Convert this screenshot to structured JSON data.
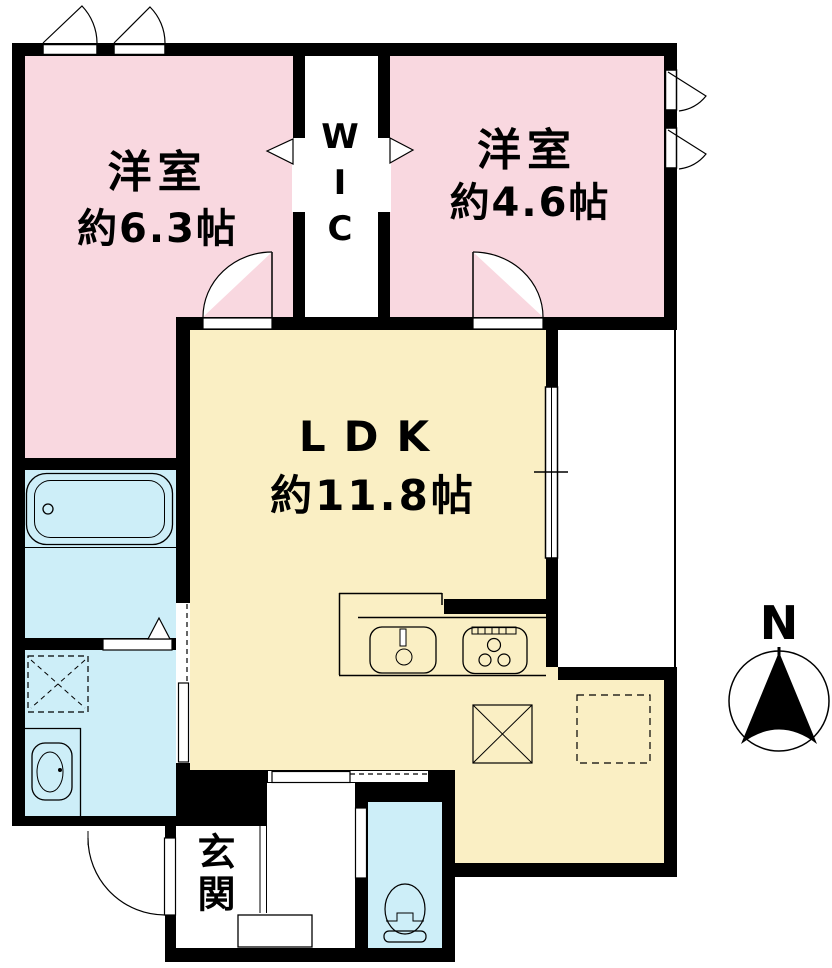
{
  "rooms": {
    "bedroom_west": {
      "name": "洋室",
      "size": "約6.3帖"
    },
    "bedroom_east": {
      "name": "洋室",
      "size": "約4.6帖"
    },
    "ldk": {
      "name": "LDK",
      "size": "約11.8帖"
    },
    "wic": {
      "name": "WIC"
    },
    "entrance": {
      "name": "玄関"
    }
  },
  "compass": {
    "label": "N"
  },
  "colors": {
    "bedroom": "#f9d8e0",
    "ldk": "#faefc4",
    "wet_area": "#cdeef8",
    "wall": "#000000",
    "background": "#ffffff"
  },
  "fixtures": {
    "bathtub": "bathtub",
    "vanity": "vanity-sink",
    "washer_space": "washing-machine-space",
    "kitchen_sink": "kitchen-sink",
    "stove": "gas-stove",
    "storage_square": "storage-space",
    "refrigerator_space": "refrigerator-space",
    "toilet": "toilet",
    "entrance_door": "entrance-door",
    "entrance_step": "entrance-step",
    "balcony": "balcony",
    "compass": "north-compass"
  }
}
